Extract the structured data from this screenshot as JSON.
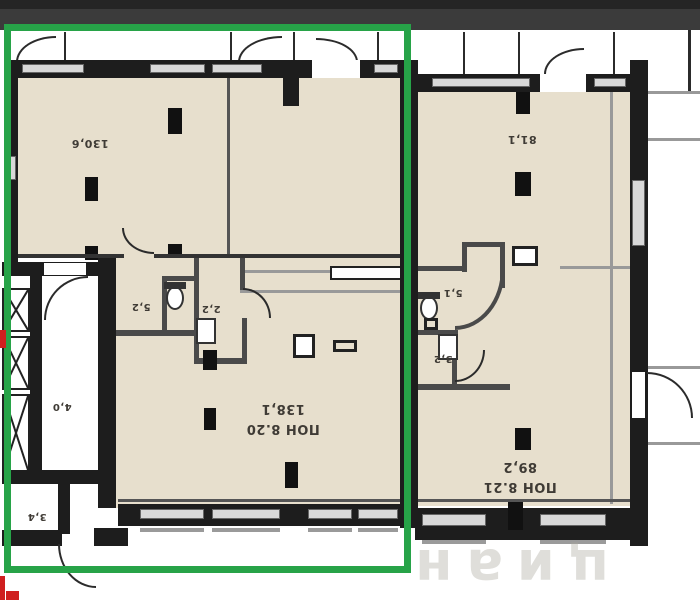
{
  "header": {
    "bar_color": "#3b3b3b"
  },
  "annotation": {
    "selection_box_color": "#27a348",
    "red_marker_color": "#cf1f1f"
  },
  "floorplan": {
    "orientation": "rotated-180",
    "colors": {
      "room_fill": "#e7dfcd",
      "wall": "#1d1d1d",
      "partition": "#4a4a4a",
      "window_fill": "#d8d8d8"
    },
    "labels": {
      "area_130_6": "130,6",
      "area_81_1": "81,1",
      "area_5_2": "5,2",
      "area_2_2": "2,2",
      "area_4_0": "4,0",
      "area_3_4": "3,4",
      "area_5_1": "5,1",
      "area_3_2": "3,2",
      "pon_8_20_name": "ПОН 8.20",
      "pon_8_20_area": "138,1",
      "pon_8_21_name": "ПОН 8.21",
      "pon_8_21_area": "89,2"
    },
    "watermark": "циан"
  }
}
